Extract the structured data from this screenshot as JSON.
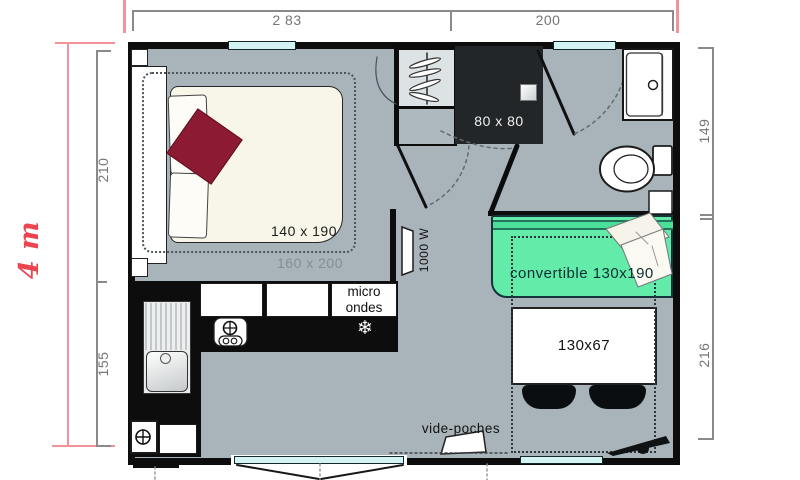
{
  "dimensions": {
    "width_left": "2 83",
    "width_right": "200",
    "total_height": "4 m",
    "height_top_left": "210",
    "height_bottom_left": "155",
    "height_top_right": "149",
    "height_bottom_right": "216"
  },
  "furniture": {
    "shower_label": "80 x 80",
    "bed_label": "140 x 190",
    "bed_zone_label": "160 x 200",
    "microwave_line1": "micro",
    "microwave_line2": "ondes",
    "heater_label": "1000 W",
    "sofa_label": "convertible 130x190",
    "table_label": "130x67",
    "pocket_label": "vide-poches"
  },
  "icons": {
    "freezer_glyph": "❄"
  },
  "colors": {
    "floor": "#a9b4ba",
    "wall": "#0d0d0d",
    "sofa_green": "#62eba9",
    "window_cyan": "#d3f4f3",
    "bed_cream": "#f8f6e9",
    "blanket_red": "#8c1a33",
    "dimension_pink": "#ee4450",
    "shower_dark": "#232628"
  }
}
